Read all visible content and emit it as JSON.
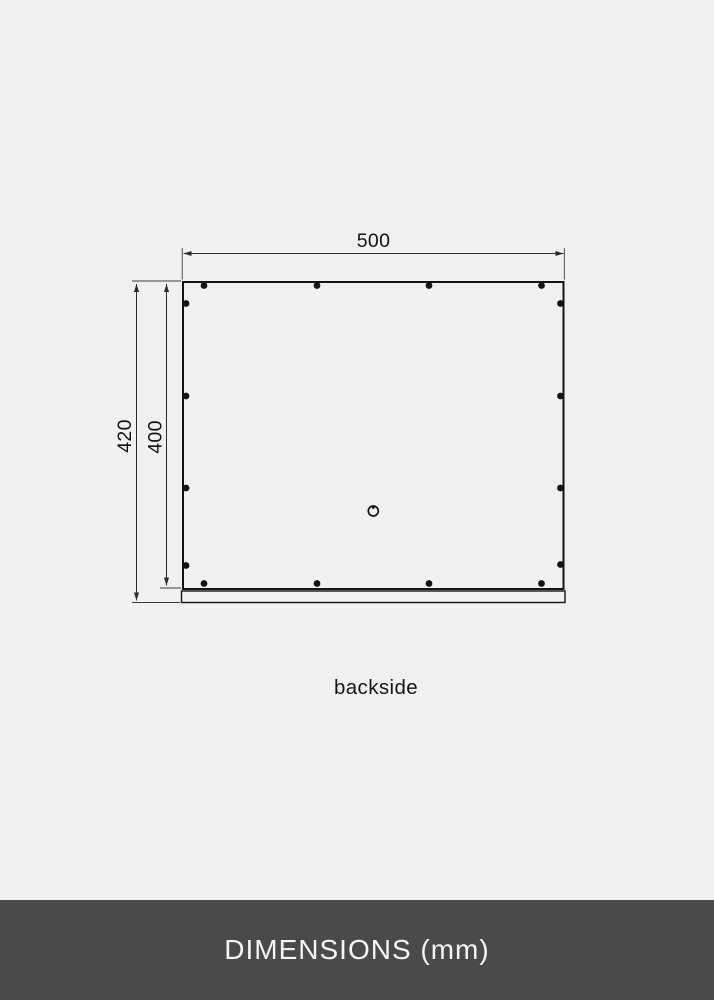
{
  "page": {
    "background_color": "#f1f1f1"
  },
  "diagram": {
    "caption": "backside",
    "dimensions": {
      "width_label": "500",
      "total_height_label": "420",
      "inner_height_label": "400",
      "unit": "mm"
    },
    "line_color": "#141414",
    "mounting_dots": {
      "radius": 3.4,
      "top": [
        [
          204,
          285.5
        ],
        [
          317,
          285.5
        ],
        [
          429,
          285.5
        ],
        [
          541.5,
          285.5
        ]
      ],
      "bottom": [
        [
          204,
          583.5
        ],
        [
          317,
          583.5
        ],
        [
          429,
          583.5
        ],
        [
          541.5,
          583.5
        ]
      ],
      "left": [
        [
          186,
          303.5
        ],
        [
          186,
          396
        ],
        [
          186,
          488
        ],
        [
          186,
          565.5
        ]
      ],
      "right": [
        [
          560.5,
          303.5
        ],
        [
          560.5,
          396
        ],
        [
          560.5,
          488
        ],
        [
          560.5,
          564.5
        ]
      ]
    },
    "keyhole": {
      "cx": 373.3,
      "cy": 511,
      "outer_radius": 5,
      "inner_dot_radius": 1.4
    }
  },
  "footer": {
    "label": "DIMENSIONS (mm)",
    "background_color": "#4a4a4a",
    "text_color": "#f5f5f5"
  }
}
